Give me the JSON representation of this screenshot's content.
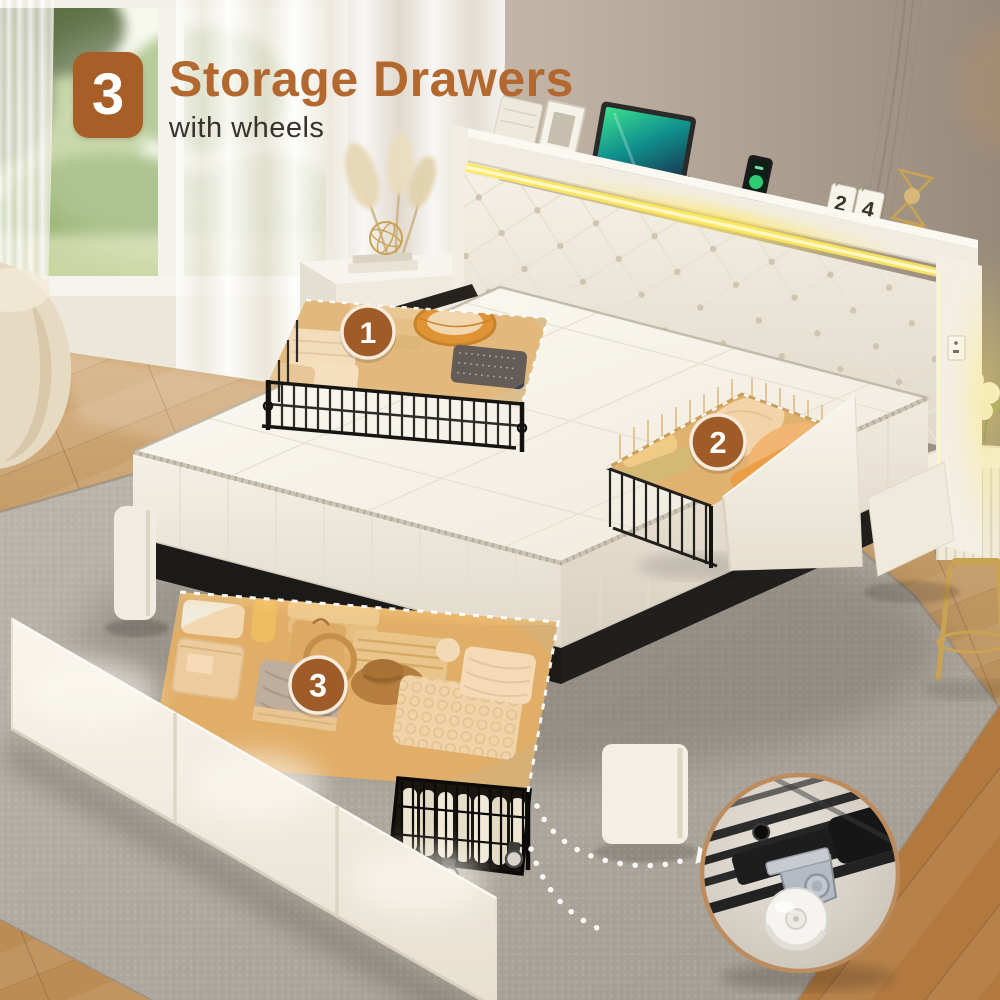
{
  "header": {
    "badge_number": "3",
    "title": "Storage Drawers",
    "subtitle": "with wheels"
  },
  "drawer_markers": [
    {
      "label": "1"
    },
    {
      "label": "2"
    },
    {
      "label": "3"
    }
  ],
  "headboard_shelf": {
    "calendar_digits": [
      "2",
      "4"
    ]
  },
  "colors": {
    "accent_brown": "#A85F27",
    "title_brown": "#B2682E",
    "subtitle_dark": "#38332E",
    "marker_fill": "#A05C28",
    "marker_ring": "#F6EBDC",
    "led_yellow": "#FFE95C",
    "drawer_glow": "#F5A94B",
    "inset_ring": "#BC8C5E",
    "rug_gray": "#B0AAA0",
    "wood_brown": "#C1945F",
    "wall_taupe": "#B3A698",
    "mattress_white": "#F7F3EA"
  }
}
